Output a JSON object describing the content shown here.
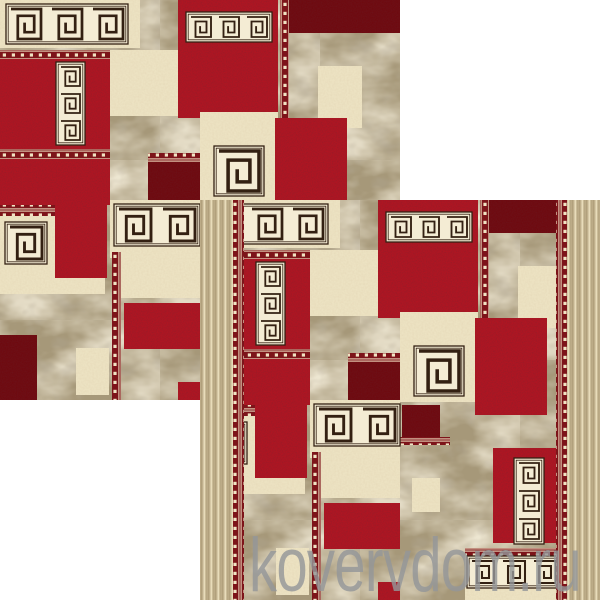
{
  "page": {
    "background": "#ffffff",
    "width": 600,
    "height": 600,
    "content_description": "two overlapping square photos of the same red/cream/beige patchwork rug with greek-key motifs, shop watermark at bottom"
  },
  "watermark": {
    "text": "kovervdom.ru",
    "left": 249,
    "top": 528,
    "font_size": 76,
    "scale_x": 0.74,
    "color": "rgba(148,150,152,0.82)"
  },
  "photos": {
    "back": {
      "x": 0,
      "y": 0,
      "w": 400,
      "h": 400,
      "has_side_borders": false
    },
    "front": {
      "x": 200,
      "y": 200,
      "w": 400,
      "h": 400,
      "has_side_borders": true
    }
  },
  "palette": {
    "background": "#ffffff",
    "red": "#ae1522",
    "maroon": "#6e0a10",
    "cream": "#ece2c2",
    "band_bg": "#f4ecd4",
    "marble_base": "#a69879",
    "marble_light": "#d9ccab",
    "marble_dark": "#776a54",
    "border_beige": "#cbbc98",
    "border_streak_dark": "#b1a07c",
    "border_streak_light": "#e8dcba",
    "guard_bg": "#7d141a",
    "guard_dot": "#f0e3c3",
    "motif_stroke": "#332012"
  },
  "rug_design": {
    "canvas": [
      400,
      400
    ],
    "patches": [
      {
        "x": 0,
        "y": 0,
        "w": 140,
        "h": 48,
        "f": "cream"
      },
      {
        "x": 178,
        "y": 0,
        "w": 100,
        "h": 118,
        "f": "red"
      },
      {
        "x": 280,
        "y": 0,
        "w": 9,
        "h": 155,
        "f": "guardV"
      },
      {
        "x": 289,
        "y": 0,
        "w": 111,
        "h": 33,
        "f": "maroon"
      },
      {
        "x": 318,
        "y": 66,
        "w": 44,
        "h": 62,
        "f": "cream"
      },
      {
        "x": 0,
        "y": 50,
        "w": 110,
        "h": 9,
        "f": "guardH"
      },
      {
        "x": 0,
        "y": 59,
        "w": 110,
        "h": 90,
        "f": "red"
      },
      {
        "x": 110,
        "y": 50,
        "w": 68,
        "h": 66,
        "f": "cream"
      },
      {
        "x": 200,
        "y": 112,
        "w": 78,
        "h": 90,
        "f": "cream"
      },
      {
        "x": 275,
        "y": 118,
        "w": 72,
        "h": 97,
        "f": "red"
      },
      {
        "x": 148,
        "y": 153,
        "w": 52,
        "h": 9,
        "f": "guardH"
      },
      {
        "x": 148,
        "y": 162,
        "w": 52,
        "h": 40,
        "f": "maroon"
      },
      {
        "x": 0,
        "y": 149,
        "w": 110,
        "h": 10,
        "f": "guardH"
      },
      {
        "x": 0,
        "y": 159,
        "w": 110,
        "h": 46,
        "f": "red"
      },
      {
        "x": 0,
        "y": 205,
        "w": 55,
        "h": 11,
        "f": "guardH"
      },
      {
        "x": 0,
        "y": 216,
        "w": 55,
        "h": 68,
        "f": "cream"
      },
      {
        "x": 55,
        "y": 205,
        "w": 52,
        "h": 73,
        "f": "red"
      },
      {
        "x": 110,
        "y": 200,
        "w": 90,
        "h": 58,
        "f": "cream"
      },
      {
        "x": 0,
        "y": 278,
        "w": 105,
        "h": 16,
        "f": "cream"
      },
      {
        "x": 0,
        "y": 335,
        "w": 37,
        "h": 65,
        "f": "maroon"
      },
      {
        "x": 76,
        "y": 348,
        "w": 33,
        "h": 47,
        "f": "cream"
      },
      {
        "x": 112,
        "y": 252,
        "w": 9,
        "h": 148,
        "f": "guardV"
      },
      {
        "x": 121,
        "y": 258,
        "w": 79,
        "h": 40,
        "f": "cream"
      },
      {
        "x": 124,
        "y": 303,
        "w": 76,
        "h": 46,
        "f": "red"
      },
      {
        "x": 178,
        "y": 382,
        "w": 22,
        "h": 18,
        "f": "red"
      },
      {
        "x": 202,
        "y": 205,
        "w": 38,
        "h": 32,
        "f": "maroon"
      },
      {
        "x": 200,
        "y": 237,
        "w": 50,
        "h": 8,
        "f": "guardH"
      },
      {
        "x": 212,
        "y": 278,
        "w": 28,
        "h": 34,
        "f": "cream"
      },
      {
        "x": 293,
        "y": 248,
        "w": 67,
        "h": 95,
        "f": "red"
      },
      {
        "x": 265,
        "y": 348,
        "w": 95,
        "h": 8,
        "f": "guardH"
      },
      {
        "x": 265,
        "y": 356,
        "w": 95,
        "h": 44,
        "f": "cream"
      }
    ],
    "motifs": [
      {
        "t": "band",
        "x": 10,
        "y": 8,
        "s": 32,
        "n": 3
      },
      {
        "t": "band",
        "x": 190,
        "y": 16,
        "s": 22,
        "n": 3
      },
      {
        "t": "stack",
        "x": 60,
        "y": 66,
        "s": 21,
        "n": 3
      },
      {
        "t": "single",
        "x": 218,
        "y": 150,
        "s": 42,
        "n": 1
      },
      {
        "t": "single",
        "x": 9,
        "y": 226,
        "s": 34,
        "n": 1
      },
      {
        "t": "band",
        "x": 118,
        "y": 208,
        "s": 34,
        "n": 2
      },
      {
        "t": "stack",
        "x": 318,
        "y": 262,
        "s": 22,
        "n": 3
      },
      {
        "t": "band",
        "x": 271,
        "y": 360,
        "s": 24,
        "n": 3
      }
    ],
    "borders": {
      "edge_width": 33,
      "guard_width": 11
    }
  }
}
